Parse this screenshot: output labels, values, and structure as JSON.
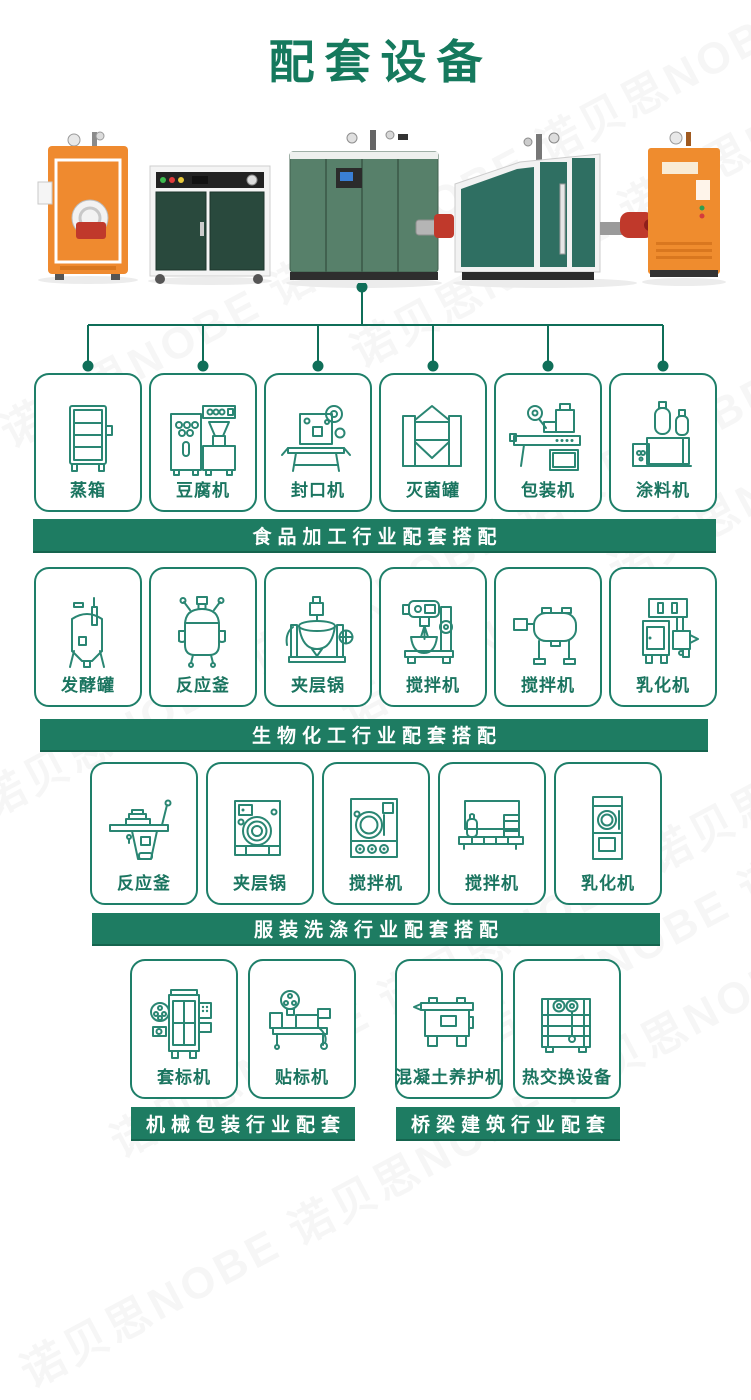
{
  "page": {
    "title": "配套设备"
  },
  "watermark": {
    "text": "诺贝思NOBE 诺贝思NOBE 诺贝思NOBE"
  },
  "colors": {
    "title_green": "#15795d",
    "banner_green": "#1e7c62",
    "card_border_teal": "#1e7f69",
    "icon_teal": "#2a8673",
    "product_orange": "#ef8a2f",
    "product_dark_green": "#29493d",
    "product_green": "#57806a",
    "burner_red": "#c0392b"
  },
  "products": [
    {
      "name": "vertical-steam-boiler-orange"
    },
    {
      "name": "electric-steam-boiler-cabinet"
    },
    {
      "name": "gas-steam-generator-green"
    },
    {
      "name": "large-steam-boiler-unit"
    },
    {
      "name": "electric-steam-generator-orange"
    }
  ],
  "sections": [
    {
      "banner": "食品加工行业配套搭配",
      "items": [
        {
          "label": "蒸箱",
          "icon": "steam-cabinet-icon"
        },
        {
          "label": "豆腐机",
          "icon": "tofu-machine-icon"
        },
        {
          "label": "封口机",
          "icon": "sealing-machine-icon"
        },
        {
          "label": "灭菌罐",
          "icon": "sterilizing-tank-icon"
        },
        {
          "label": "包装机",
          "icon": "packaging-machine-icon"
        },
        {
          "label": "涂料机",
          "icon": "coating-machine-icon"
        }
      ]
    },
    {
      "banner": "生物化工行业配套搭配",
      "items": [
        {
          "label": "发酵罐",
          "icon": "fermentation-tank-icon"
        },
        {
          "label": "反应釜",
          "icon": "reactor-icon"
        },
        {
          "label": "夹层锅",
          "icon": "jacketed-kettle-icon"
        },
        {
          "label": "搅拌机",
          "icon": "planetary-mixer-icon"
        },
        {
          "label": "搅拌机",
          "icon": "drum-mixer-icon"
        },
        {
          "label": "乳化机",
          "icon": "emulsifier-icon"
        }
      ]
    },
    {
      "banner": "服装洗涤行业配套搭配",
      "items": [
        {
          "label": "反应釜",
          "icon": "ironing-table-icon"
        },
        {
          "label": "夹层锅",
          "icon": "washing-machine-icon"
        },
        {
          "label": "搅拌机",
          "icon": "dryer-icon"
        },
        {
          "label": "搅拌机",
          "icon": "washing-line-icon"
        },
        {
          "label": "乳化机",
          "icon": "vertical-dryer-icon"
        }
      ]
    },
    {
      "banner": "机械包装行业配套",
      "items": [
        {
          "label": "套标机",
          "icon": "sleeve-labeling-machine-icon"
        },
        {
          "label": "贴标机",
          "icon": "labeling-machine-icon"
        }
      ]
    },
    {
      "banner": "桥梁建筑行业配套",
      "items": [
        {
          "label": "混凝土养护机",
          "icon": "concrete-curing-machine-icon"
        },
        {
          "label": "热交换设备",
          "icon": "heat-exchanger-icon"
        }
      ]
    }
  ]
}
